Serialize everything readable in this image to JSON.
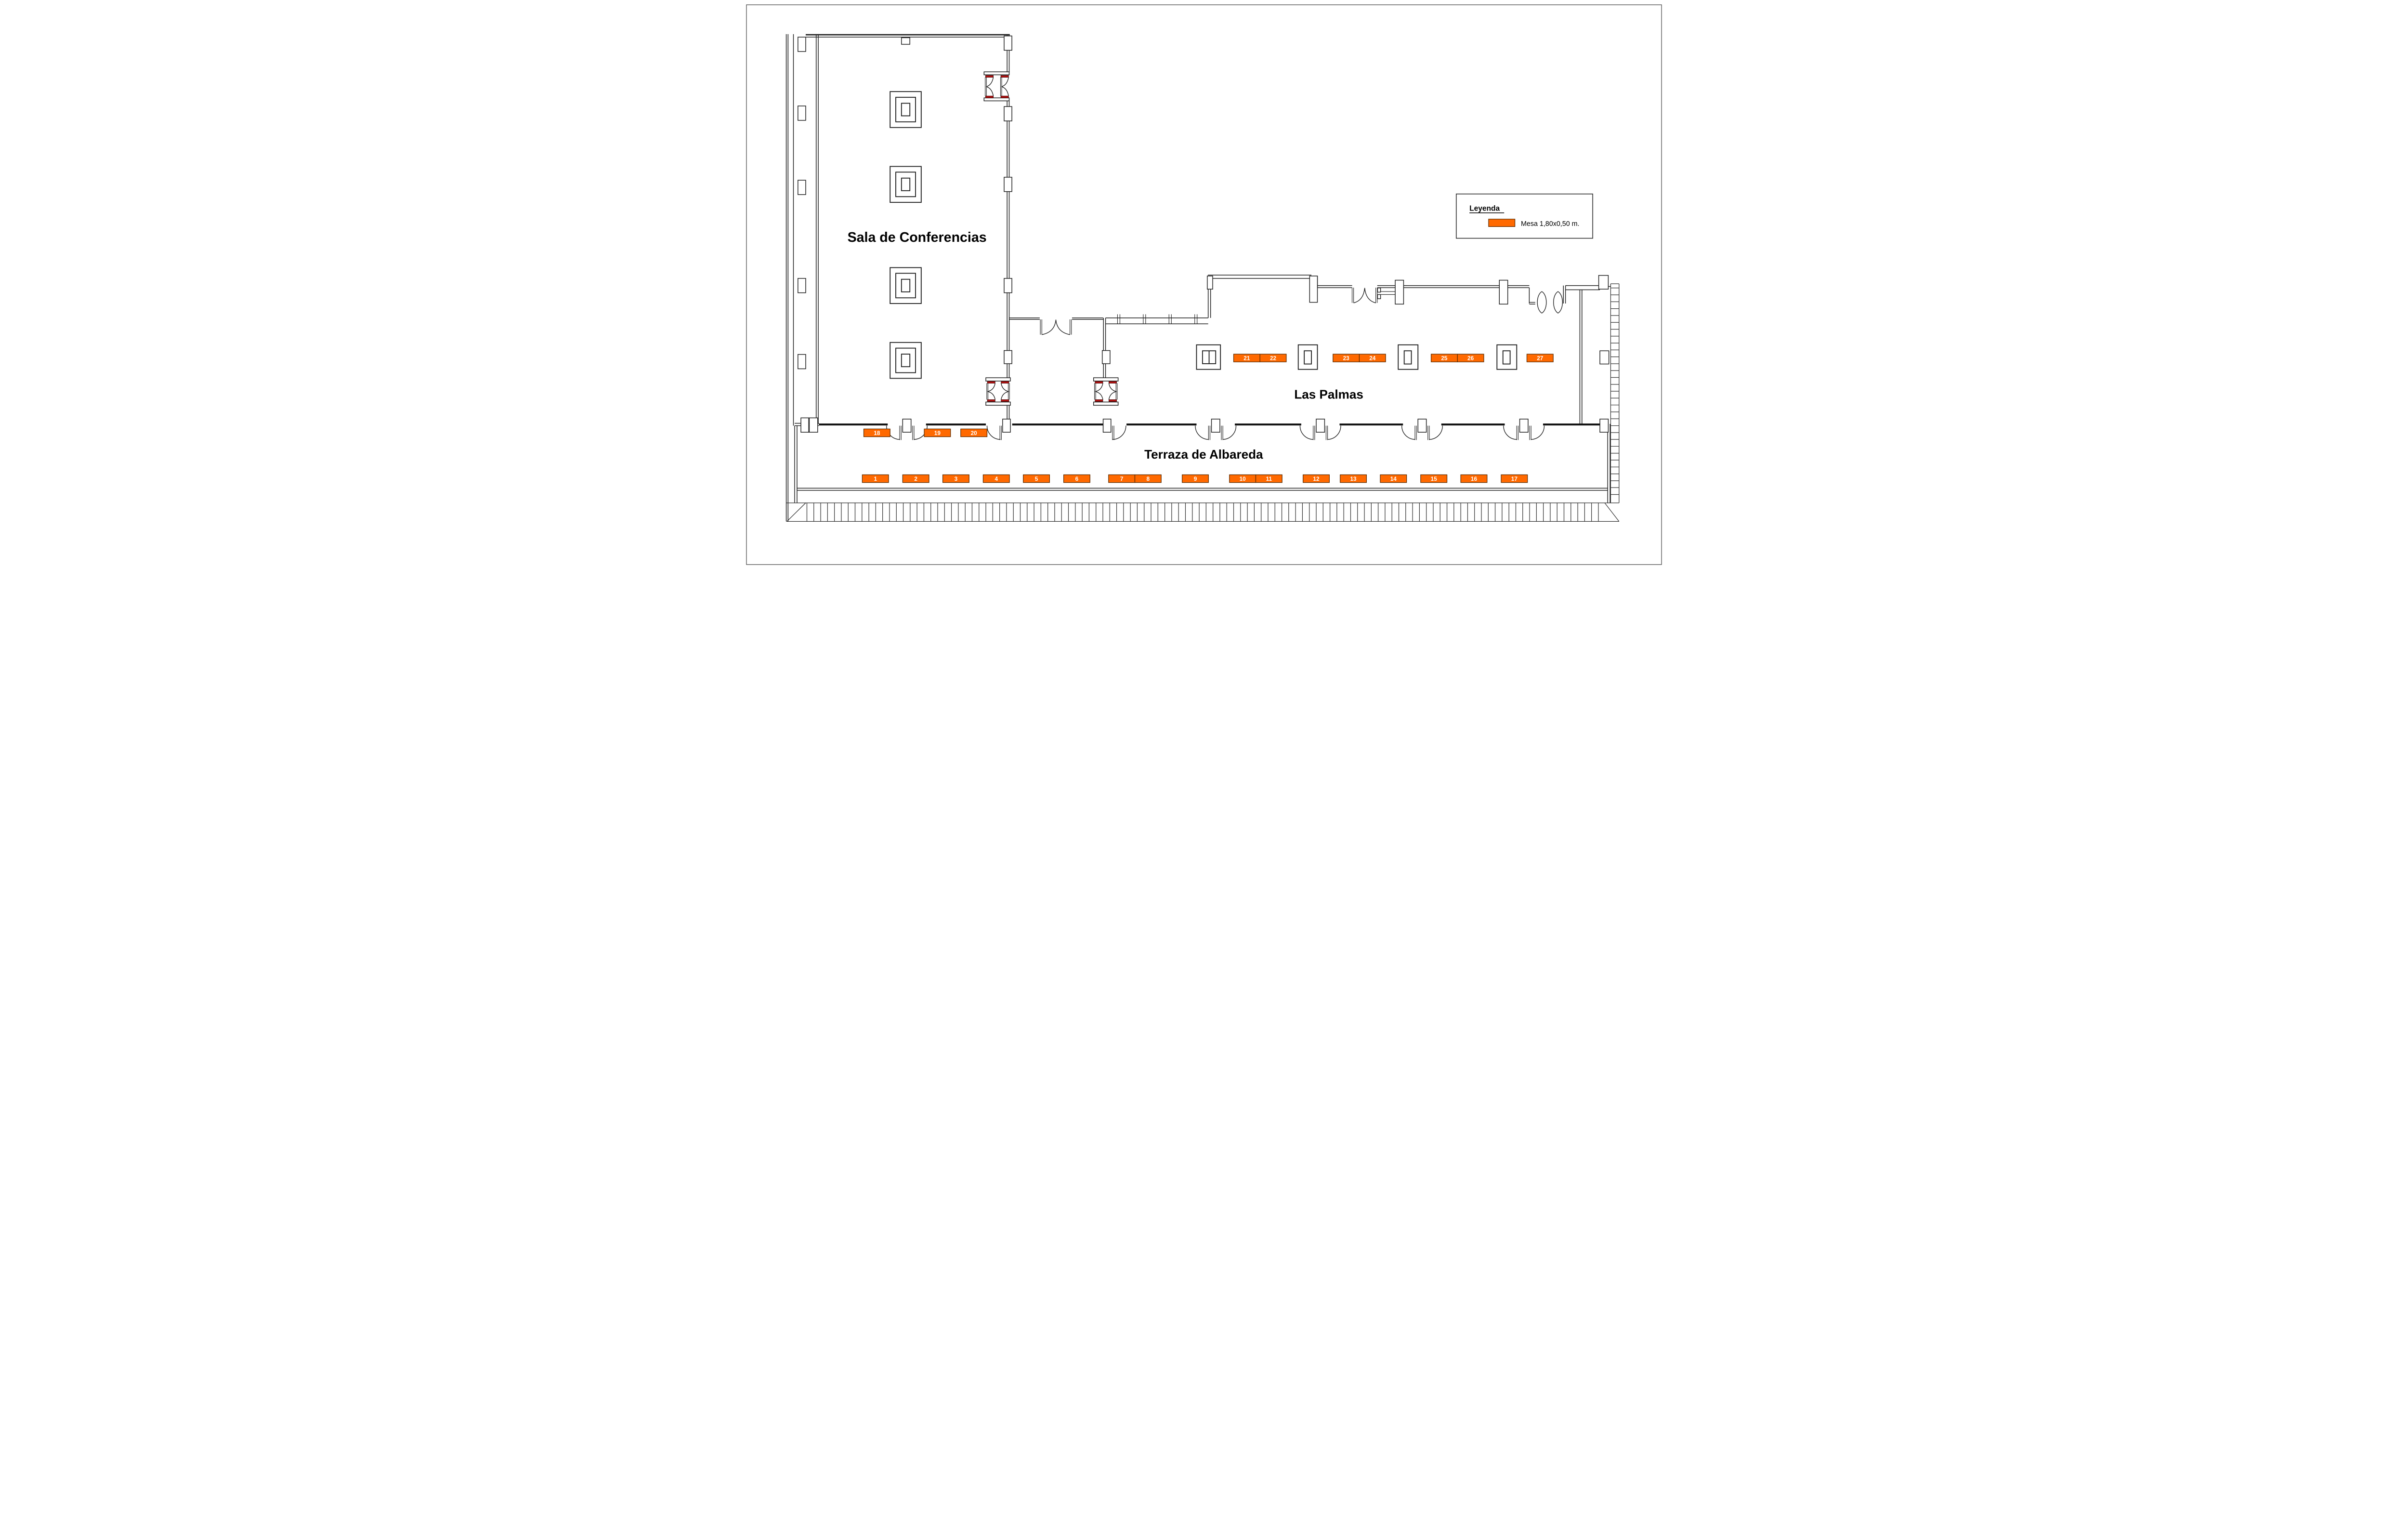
{
  "rooms": {
    "conference": "Sala de Conferencias",
    "palmas": "Las Palmas",
    "terrace": "Terraza de Albareda"
  },
  "legend": {
    "title": "Leyenda",
    "item_label": "Mesa 1,80x0,50 m."
  },
  "tables": {
    "terrace_row": [
      "1",
      "2",
      "3",
      "4",
      "5",
      "6",
      "7",
      "8",
      "9",
      "10",
      "11",
      "12",
      "13",
      "14",
      "15",
      "16",
      "17"
    ],
    "terrace_wall": [
      "18",
      "19",
      "20"
    ],
    "palmas": [
      "21",
      "22",
      "23",
      "24",
      "25",
      "26",
      "27"
    ]
  },
  "colors": {
    "table_fill": "#FF6900",
    "table_border": "#5A2A00",
    "door_leaf": "#B01212",
    "wall": "#222222",
    "wall_dark": "#111111"
  }
}
